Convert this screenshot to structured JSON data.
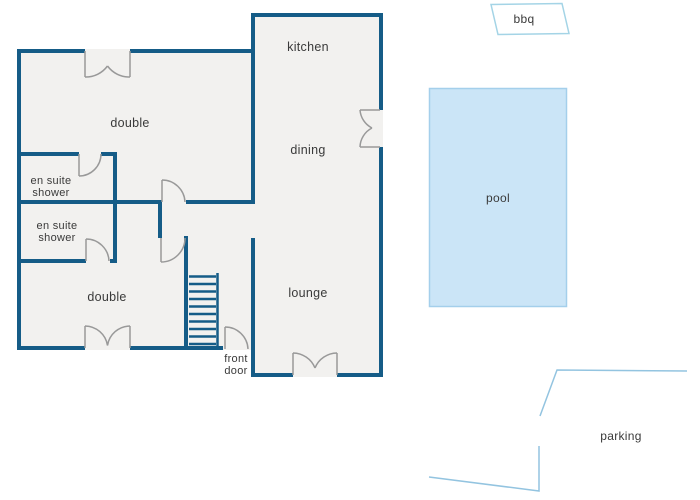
{
  "diagram_type": "property floor plan",
  "colors": {
    "wall": "#155c87",
    "floor_fill": "#f2f1ef",
    "door_arc": "#999999",
    "pool_fill": "#cbe5f7",
    "pool_border": "#a4cfeb",
    "bbq_border": "#a4d4e6",
    "parking_line": "#93c4e0",
    "text": "#3a3a3a",
    "background": "#ffffff"
  },
  "floor_plan": {
    "rooms": [
      {
        "id": "kitchen",
        "label": "kitchen"
      },
      {
        "id": "dining",
        "label": "dining"
      },
      {
        "id": "lounge",
        "label": "lounge"
      },
      {
        "id": "double-top",
        "label": "double"
      },
      {
        "id": "double-bottom",
        "label": "double"
      },
      {
        "id": "ensuite-top",
        "label_line1": "en suite",
        "label_line2": "shower"
      },
      {
        "id": "ensuite-bottom",
        "label_line1": "en suite",
        "label_line2": "shower"
      }
    ],
    "entrance": {
      "label_line1": "front",
      "label_line2": "door"
    },
    "stairs": {
      "steps": 10
    }
  },
  "outdoor": {
    "bbq": {
      "label": "bbq"
    },
    "pool": {
      "label": "pool"
    },
    "parking": {
      "label": "parking"
    }
  }
}
